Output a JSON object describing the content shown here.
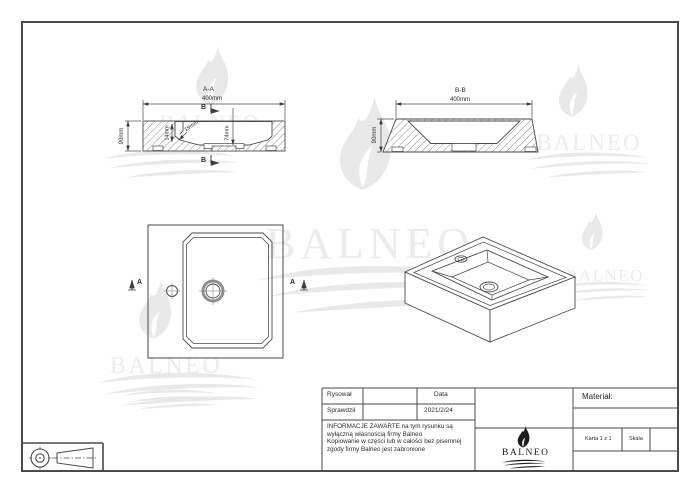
{
  "watermark_brand": "BALNEO",
  "views": {
    "section_aa": {
      "title": "A-A",
      "width_dim": "400mm",
      "height_dim": "90mm",
      "step_dim": "14mm",
      "wall_dim": "19mm",
      "bowl_depth_dim": "74mm",
      "cut_label": "B"
    },
    "section_bb": {
      "title": "B-B",
      "width_dim": "400mm",
      "height_dim": "90mm"
    },
    "top_view": {
      "cut_label": "A"
    }
  },
  "title_block": {
    "drawn_label": "Rysował",
    "checked_label": "Sprawdził",
    "date_label": "Data",
    "date_value": "2021/2/24",
    "notice_lines": [
      "INFORMACJE ZAWARTE na tym rysunku są",
      "wyłączną własnością firmy Balneo",
      "Kopiowanie w części lub w całości bez pisemnej",
      "zgody firmy Balneo jest zabronione"
    ],
    "material_label": "Materiał:",
    "sheet_label": "Karta 1 z 1",
    "scale_label": "Skala",
    "brand": "BALNEO"
  },
  "colors": {
    "line": "#4a4a4a",
    "watermark": "#e9e9e9",
    "drain_ring": "#8f8f8f"
  }
}
